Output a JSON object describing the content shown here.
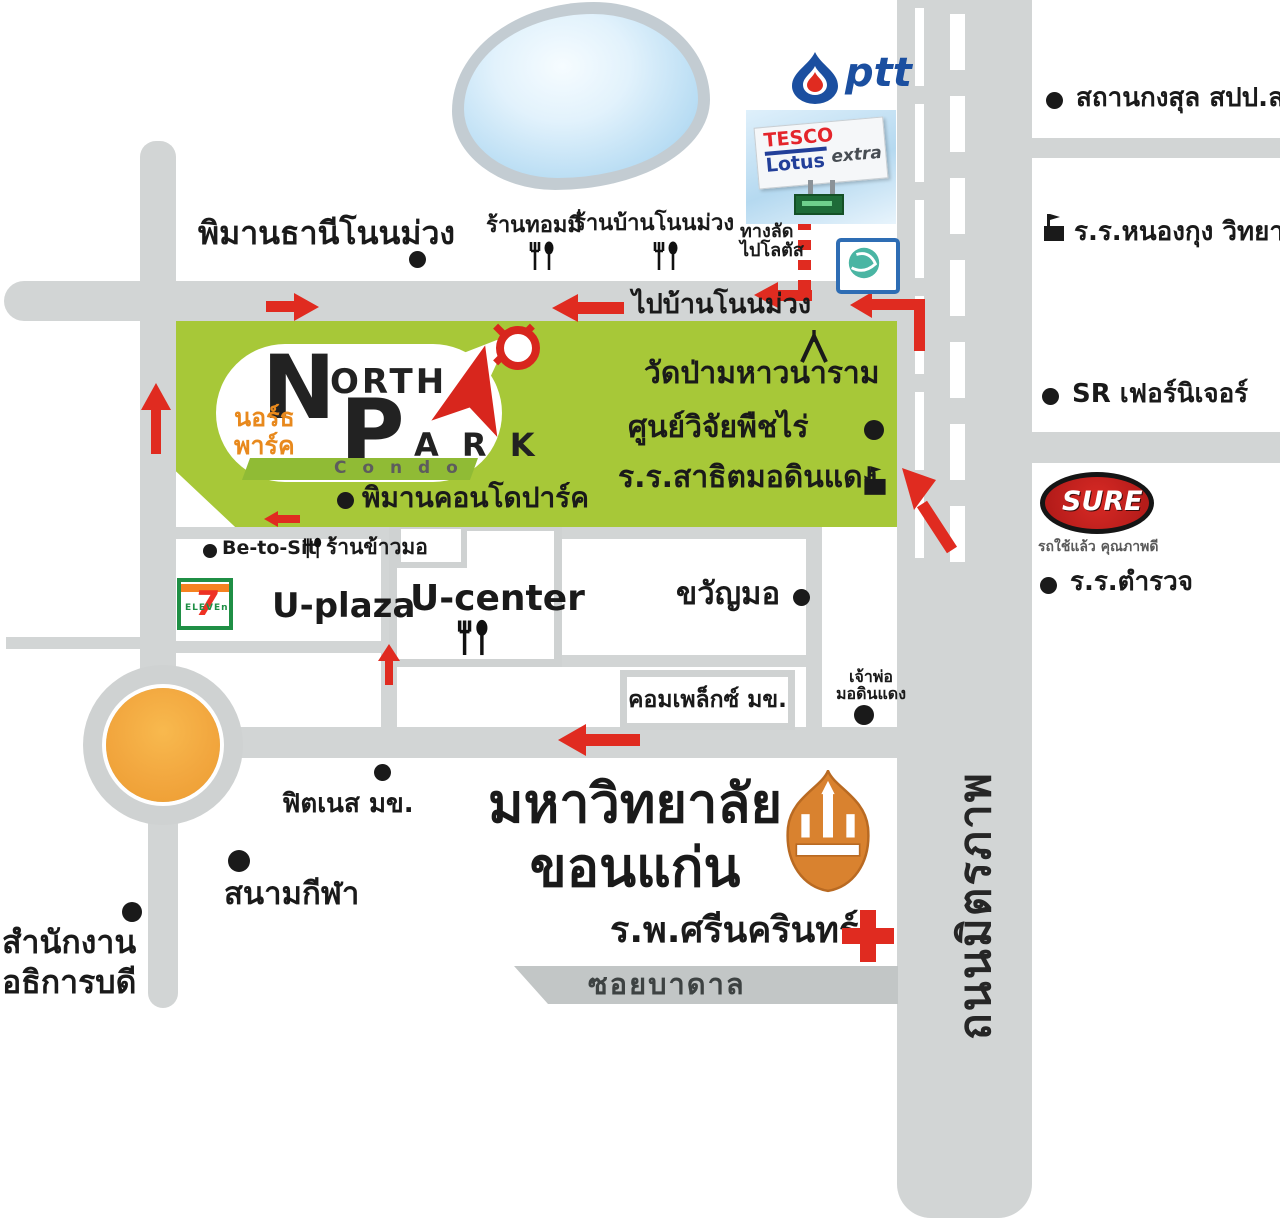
{
  "landmarks": {
    "piman_thani": "พิมานธานีโนนม่วง",
    "tommy_shop": "ร้านทอมมี่",
    "ban_non_muang_shop": "ร้านบ้านโนนม่วง",
    "shortcut_line1": "ทางลัด",
    "shortcut_line2": "ไปโลตัส",
    "to_ban_non_muang": "ไปบ้านโนนม่วง",
    "lao_consulate": "สถานกงสุล สปป.ลาว",
    "nong_kung_school": "ร.ร.หนองกุง วิทยาคาร",
    "wat_pa": "วัดป่ามหาวนาราม",
    "crop_research_center": "ศูนย์วิจัยพืชไร่",
    "satit_school": "ร.ร.สาธิตมอดินแดง",
    "piman_condo_park": "พิมานคอนโดปาร์ค",
    "sr_furniture": "SR เฟอร์นิเจอร์",
    "police_school": "ร.ร.ตำรวจ",
    "be_to_sit": "Be-to-Sit",
    "ran_khao_mo": "ร้านข้าวมอ",
    "u_plaza": "U-plaza",
    "u_center": "U-center",
    "kwan_mo": "ขวัญมอ",
    "complex_kku": "คอมเพล็กซ์ มข.",
    "chao_por_line1": "เจ้าพ่อ",
    "chao_por_line2": "มอดินแดง",
    "fitness_kku": "ฟิตเนส มข.",
    "stadium": "สนามกีฬา",
    "president_office_line1": "สำนักงาน",
    "president_office_line2": "อธิการบดี",
    "kku_line1": "มหาวิทยาลัย",
    "kku_line2": "ขอนแก่น",
    "srinagarind_hospital": "ร.พ.ศรีนครินทร์"
  },
  "roads": {
    "mittraphap": "ถนนมิตรภาพ",
    "soi_badan": "ซอยบาดาล"
  },
  "logos": {
    "ptt": "ptt",
    "tesco_line1": "TESCO",
    "tesco_line2": "Lotus",
    "tesco_extra": "extra",
    "seven_eleven": "7",
    "seven_eleven_sub": "ELEVEn",
    "north_park_n": "N",
    "north_park_orth": "ORTH",
    "north_park_p": "P",
    "north_park_ark": "A R K",
    "north_park_thai1": "นอร์ธ",
    "north_park_thai2": "พาร์ค",
    "north_park_condo": "C o n d o",
    "sure": "SURE",
    "sure_tagline": "รถใช้แล้ว คุณภาพดี"
  },
  "colors": {
    "road_gray": "#d2d5d5",
    "green_zone": "#a7c838",
    "arrow_red": "#e02b20",
    "roundabout_orange": "#f2a73f",
    "pond_blue": "#b7dcf3"
  }
}
